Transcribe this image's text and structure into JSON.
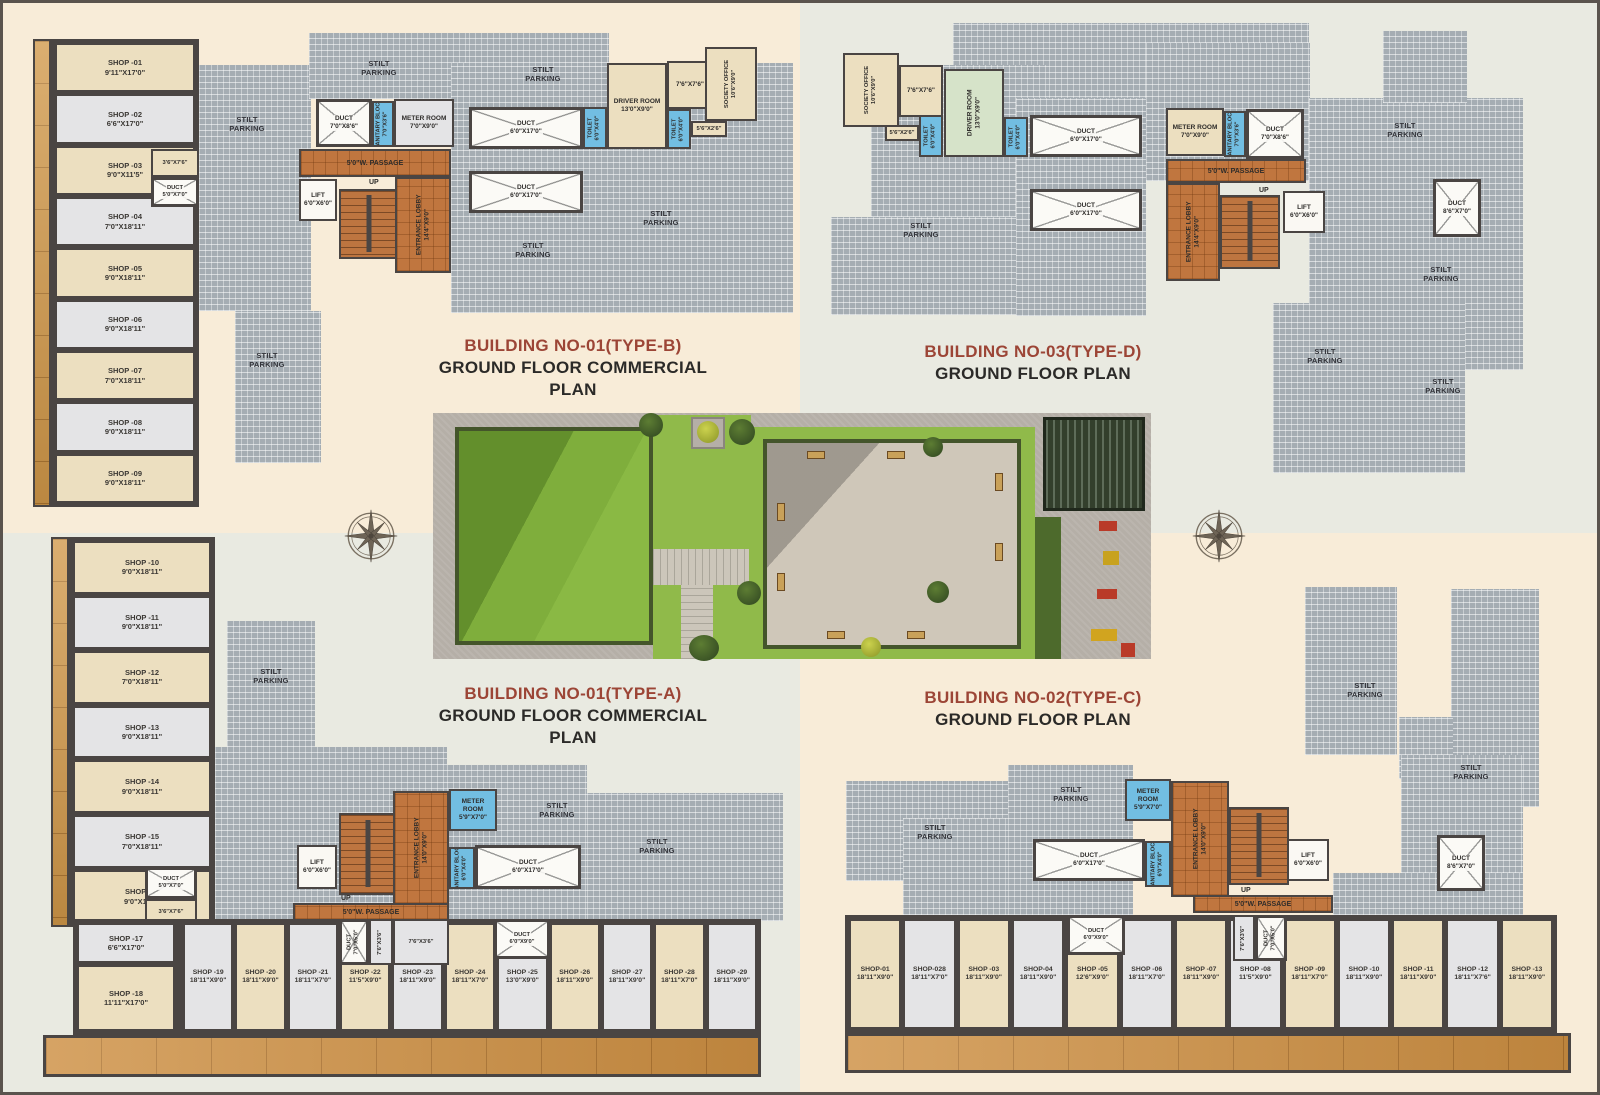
{
  "common": {
    "stilt_parking": "STILT\nPARKING",
    "up": "UP",
    "passage": "5'0\"W. PASSAGE"
  },
  "plans": {
    "b1b": {
      "title_line1": "BUILDING NO-01(TYPE-B)",
      "title_line2": "GROUND FLOOR COMMERCIAL PLAN",
      "shops": [
        {
          "name": "SHOP -01",
          "size": "9'11\"X17'0\""
        },
        {
          "name": "SHOP -02",
          "size": "6'6\"X17'0\""
        },
        {
          "name": "SHOP -03",
          "size": "9'0\"X11'5\""
        },
        {
          "name": "SHOP -04",
          "size": "7'0\"X18'11\""
        },
        {
          "name": "SHOP -05",
          "size": "9'0\"X18'11\""
        },
        {
          "name": "SHOP -06",
          "size": "9'0\"X18'11\""
        },
        {
          "name": "SHOP -07",
          "size": "7'0\"X18'11\""
        },
        {
          "name": "SHOP -08",
          "size": "9'0\"X18'11\""
        },
        {
          "name": "SHOP -09",
          "size": "9'0\"X18'11\""
        }
      ],
      "rooms": {
        "small36": "3'6\"X7'6\"",
        "duct57": {
          "label": "DUCT",
          "size": "5'0\"X7'0\""
        },
        "duct_a": {
          "label": "DUCT",
          "size": "7'0\"X8'6\""
        },
        "sanitary": {
          "label": "SANITARY BLOCK",
          "size": "7'0\"X3'6\""
        },
        "meter": {
          "label": "METER ROOM",
          "size": "7'0\"X9'0\""
        },
        "duct_b": {
          "label": "DUCT",
          "size": "6'0\"X17'0\""
        },
        "toilet1": {
          "label": "TOILET",
          "size": "6'0\"X4'0\""
        },
        "driver": {
          "label": "DRIVER ROOM",
          "size": "13'0\"X9'0\""
        },
        "toilet2": {
          "label": "TOILET",
          "size": "6'0\"X4'0\""
        },
        "room76": "7'6\"X7'6\"",
        "society": {
          "label": "SOCIETY OFFICE",
          "size": "10'6\"X9'0\""
        },
        "room56": "5'6\"X2'6\"",
        "lift": {
          "label": "LIFT",
          "size": "6'0\"X6'0\""
        },
        "lobby": {
          "label": "ENTRANCE LOBBY",
          "size": "14'4\"X9'0\""
        },
        "duct_c": {
          "label": "DUCT",
          "size": "6'0\"X17'0\""
        }
      }
    },
    "b3d": {
      "title_line1": "BUILDING NO-03(TYPE-D)",
      "title_line2": "GROUND FLOOR PLAN",
      "rooms": {
        "society": {
          "label": "SOCIETY OFFICE",
          "size": "10'6\"X9'0\""
        },
        "room76": "7'6\"X7'6\"",
        "room56": "5'6\"X2'6\"",
        "toilet1": {
          "label": "TOILET",
          "size": "6'0\"X4'0\""
        },
        "driver": {
          "label": "DRIVER ROOM",
          "size": "13'0\"X9'0\""
        },
        "toilet2": {
          "label": "TOILET",
          "size": "6'0\"X4'0\""
        },
        "duct_b": {
          "label": "DUCT",
          "size": "6'0\"X17'0\""
        },
        "duct_c": {
          "label": "DUCT",
          "size": "6'0\"X17'0\""
        },
        "meter": {
          "label": "METER ROOM",
          "size": "7'0\"X9'0\""
        },
        "sanitary": {
          "label": "SANITARY BLOCK",
          "size": "7'0\"X3'6\""
        },
        "duct_a": {
          "label": "DUCT",
          "size": "7'0\"X8'6\""
        },
        "lobby": {
          "label": "ENTRANCE LOBBY",
          "size": "14'4\"X9'0\""
        },
        "lift": {
          "label": "LIFT",
          "size": "6'0\"X6'0\""
        },
        "duct8": {
          "label": "DUCT",
          "size": "8'6\"X7'0\""
        }
      }
    },
    "b1a": {
      "title_line1": "BUILDING NO-01(TYPE-A)",
      "title_line2": "GROUND FLOOR COMMERCIAL PLAN",
      "shops_col": [
        {
          "name": "SHOP -10",
          "size": "9'0\"X18'11\""
        },
        {
          "name": "SHOP -11",
          "size": "9'0\"X18'11\""
        },
        {
          "name": "SHOP -12",
          "size": "7'0\"X18'11\""
        },
        {
          "name": "SHOP -13",
          "size": "9'0\"X18'11\""
        },
        {
          "name": "SHOP -14",
          "size": "9'0\"X18'11\""
        },
        {
          "name": "SHOP -15",
          "size": "7'0\"X18'11\""
        },
        {
          "name": "SHOP -16",
          "size": "9'0\"X11'5\""
        }
      ],
      "shops_blk": [
        {
          "name": "SHOP -17",
          "size": "6'6\"X17'0\""
        },
        {
          "name": "SHOP -18",
          "size": "11'11\"X17'0\""
        }
      ],
      "shops_row": [
        {
          "name": "SHOP -19",
          "size": "18'11\"X9'0\""
        },
        {
          "name": "SHOP -20",
          "size": "18'11\"X9'0\""
        },
        {
          "name": "SHOP -21",
          "size": "18'11\"X7'0\""
        },
        {
          "name": "SHOP -22",
          "size": "11'5\"X9'0\""
        },
        {
          "name": "SHOP -23",
          "size": "18'11\"X9'0\""
        },
        {
          "name": "SHOP -24",
          "size": "18'11\"X7'0\""
        },
        {
          "name": "SHOP -25",
          "size": "13'0\"X9'0\""
        },
        {
          "name": "SHOP -26",
          "size": "18'11\"X9'0\""
        },
        {
          "name": "SHOP -27",
          "size": "18'11\"X9'0\""
        },
        {
          "name": "SHOP -28",
          "size": "18'11\"X7'0\""
        },
        {
          "name": "SHOP -29",
          "size": "18'11\"X9'0\""
        }
      ],
      "rooms": {
        "shop16_duct": {
          "label": "DUCT",
          "size": "5'0\"X7'0\""
        },
        "shop16_small": "3'6\"X7'6\"",
        "lift": {
          "label": "LIFT",
          "size": "6'0\"X6'0\""
        },
        "lobby": {
          "label": "ENTRANCE LOBBY",
          "size": "14'0\"X9'0\""
        },
        "meter": {
          "label": "METER ROOM",
          "size": "5'9\"X7'0\""
        },
        "sanitary": {
          "label": "SANITARY BLOCK",
          "size": "6'0\"X4'0\""
        },
        "duct_b": {
          "label": "DUCT",
          "size": "6'0\"X17'0\""
        },
        "duct_row": {
          "label": "DUCT",
          "size": "7'0\"X5'0\""
        },
        "v76": "7'6\"X3'6\"",
        "small76": "7'6\"X3'6\"",
        "duct69": {
          "label": "DUCT",
          "size": "6'0\"X9'0\""
        }
      }
    },
    "b2c": {
      "title_line1": "BUILDING NO-02(TYPE-C)",
      "title_line2": "GROUND FLOOR PLAN",
      "shops_row": [
        {
          "name": "SHOP-01",
          "size": "18'11\"X9'0\""
        },
        {
          "name": "SHOP-028",
          "size": "18'11\"X7'0\""
        },
        {
          "name": "SHOP -03",
          "size": "18'11\"X9'0\""
        },
        {
          "name": "SHOP-04",
          "size": "18'11\"X9'0\""
        },
        {
          "name": "SHOP -05",
          "size": "12'6\"X9'0\""
        },
        {
          "name": "SHOP -06",
          "size": "18'11\"X7'0\""
        },
        {
          "name": "SHOP -07",
          "size": "18'11\"X9'0\""
        },
        {
          "name": "SHOP -08",
          "size": "11'5\"X9'0\""
        },
        {
          "name": "SHOP -09",
          "size": "18'11\"X7'0\""
        },
        {
          "name": "SHOP -10",
          "size": "18'11\"X9'0\""
        },
        {
          "name": "SHOP -11",
          "size": "18'11\"X9'0\""
        },
        {
          "name": "SHOP -12",
          "size": "18'11\"X7'6\""
        },
        {
          "name": "SHOP -13",
          "size": "18'11\"X9'0\""
        }
      ],
      "rooms": {
        "meter": {
          "label": "METER ROOM",
          "size": "5'9\"X7'0\""
        },
        "lobby": {
          "label": "ENTRANCE LOBBY",
          "size": "14'0\"X9'0\""
        },
        "sanitary": {
          "label": "SANITARY BLOCK",
          "size": "6'0\"X4'0\""
        },
        "duct_b": {
          "label": "DUCT",
          "size": "6'0\"X17'0\""
        },
        "lift": {
          "label": "LIFT",
          "size": "6'0\"X6'0\""
        },
        "duct8": {
          "label": "DUCT",
          "size": "8'6\"X7'0\""
        },
        "duct69": {
          "label": "DUCT",
          "size": "6'0\"X9'0\""
        },
        "v76": "7'6\"X3'6\"",
        "duct_row": {
          "label": "DUCT",
          "size": "7'0\"X5'0\""
        }
      }
    }
  }
}
